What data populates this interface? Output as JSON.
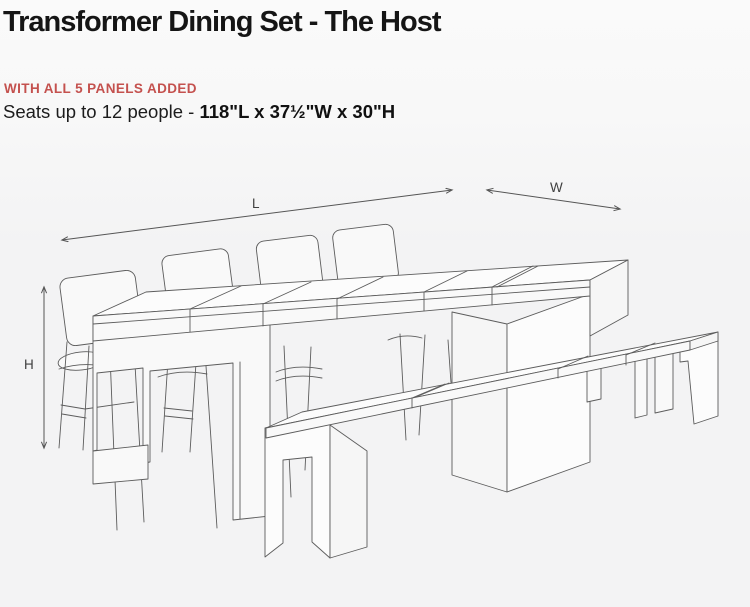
{
  "page": {
    "width": 750,
    "height": 607,
    "background": "#f3f3f4"
  },
  "header": {
    "title": "Transformer Dining Set - The Host",
    "badge": "WITH ALL 5 PANELS ADDED",
    "badge_color": "#c4514e",
    "capacity_prefix": "Seats up to 12 people - ",
    "dimensions": "118\"L x 37½\"W x 30\"H"
  },
  "diagram": {
    "stroke_color": "#5c5c5c",
    "description": "isometric line drawing of an extended dining table with four chairs and bench seating",
    "labels": {
      "length": "L",
      "width": "W",
      "height": "H"
    }
  }
}
